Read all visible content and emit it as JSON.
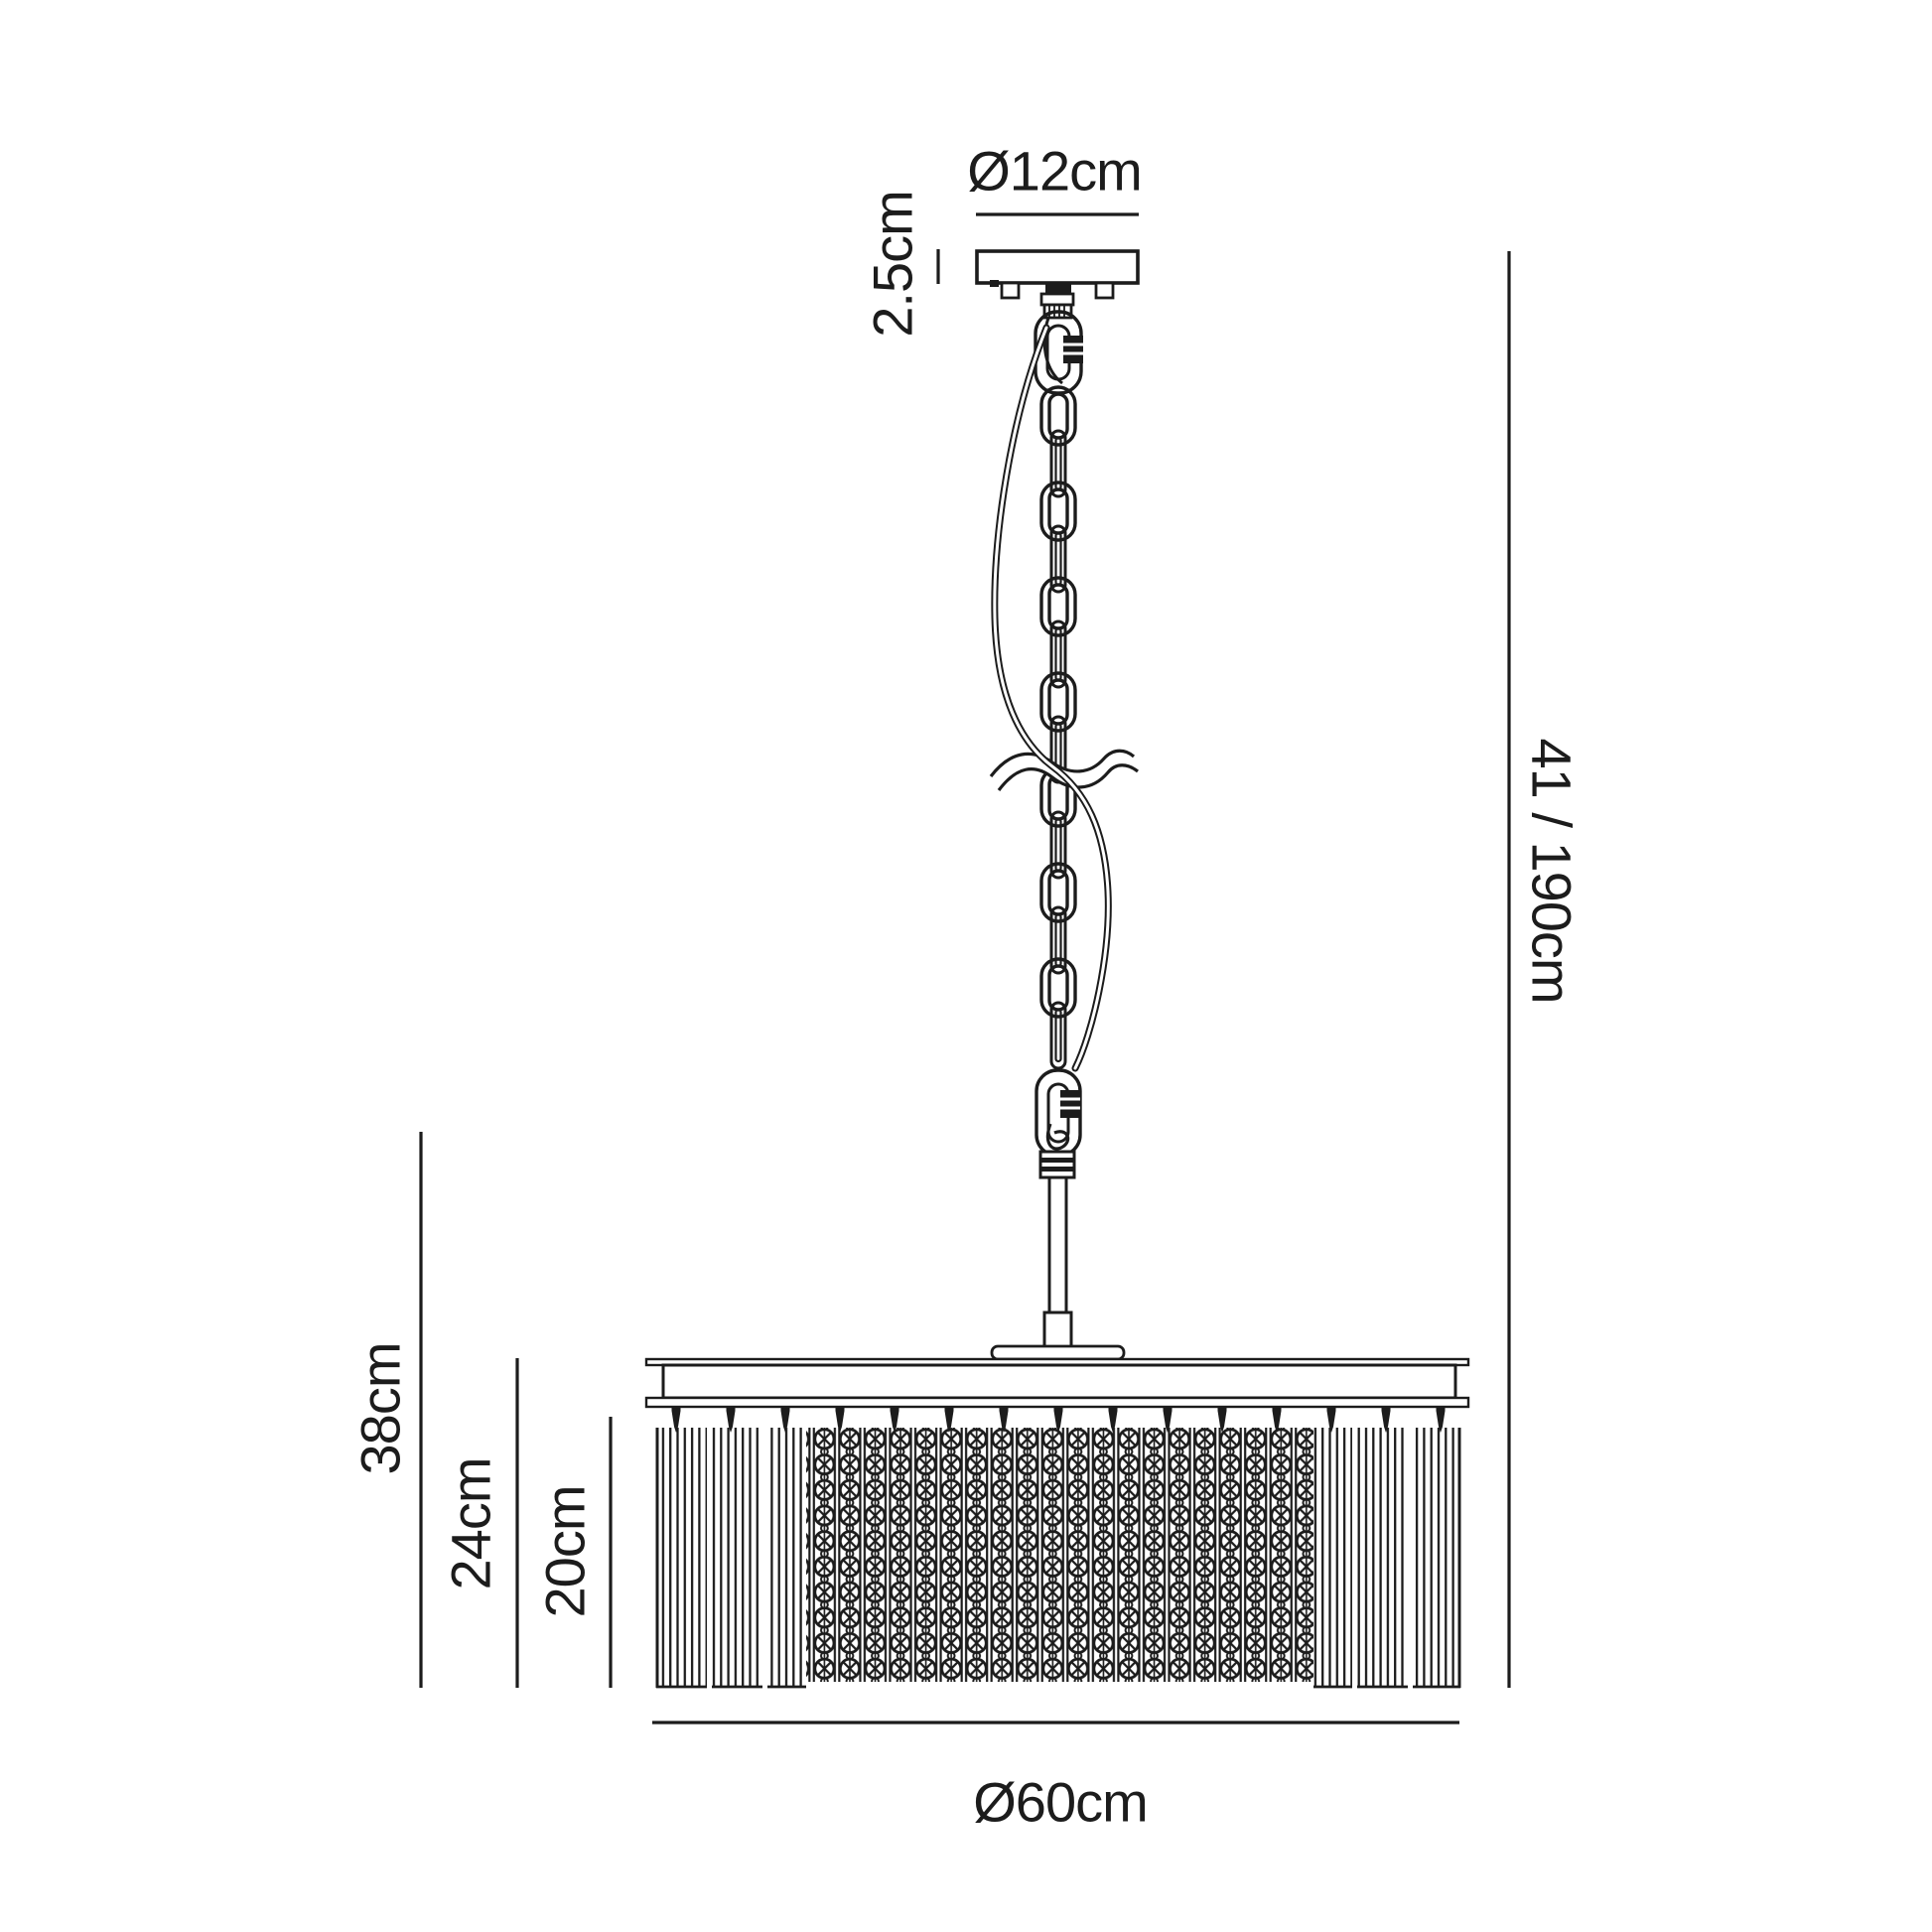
{
  "diagram": {
    "type": "technical-line-drawing",
    "subject": "crystal drum pendant ceiling light dimension diagram",
    "background": "#ffffff",
    "line_color": "#1c1c1c",
    "dimensions": {
      "canopy_diameter": {
        "label": "Ø12cm"
      },
      "canopy_height": {
        "label": "2.5cm"
      },
      "overall_drop": {
        "label": "41 / 190cm"
      },
      "frame_drop": {
        "label": "38cm"
      },
      "shade_height": {
        "label": "24cm"
      },
      "crystal_length": {
        "label": "20cm"
      },
      "shade_diameter": {
        "label": "Ø60cm"
      }
    }
  }
}
